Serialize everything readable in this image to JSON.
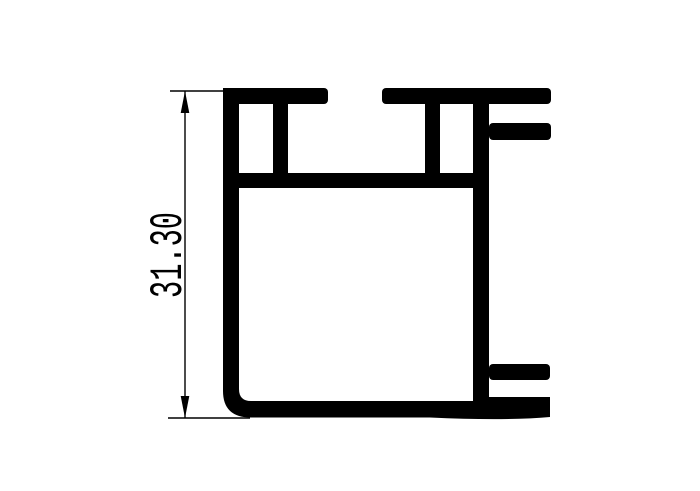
{
  "drawing": {
    "subject": "aluminum-extrusion-profile-cross-section",
    "colors": {
      "ink": "#000000",
      "background": "#ffffff"
    },
    "dimension": {
      "label": "31.30",
      "orientation": "vertical",
      "arrow_style": "filled-triangle"
    }
  }
}
